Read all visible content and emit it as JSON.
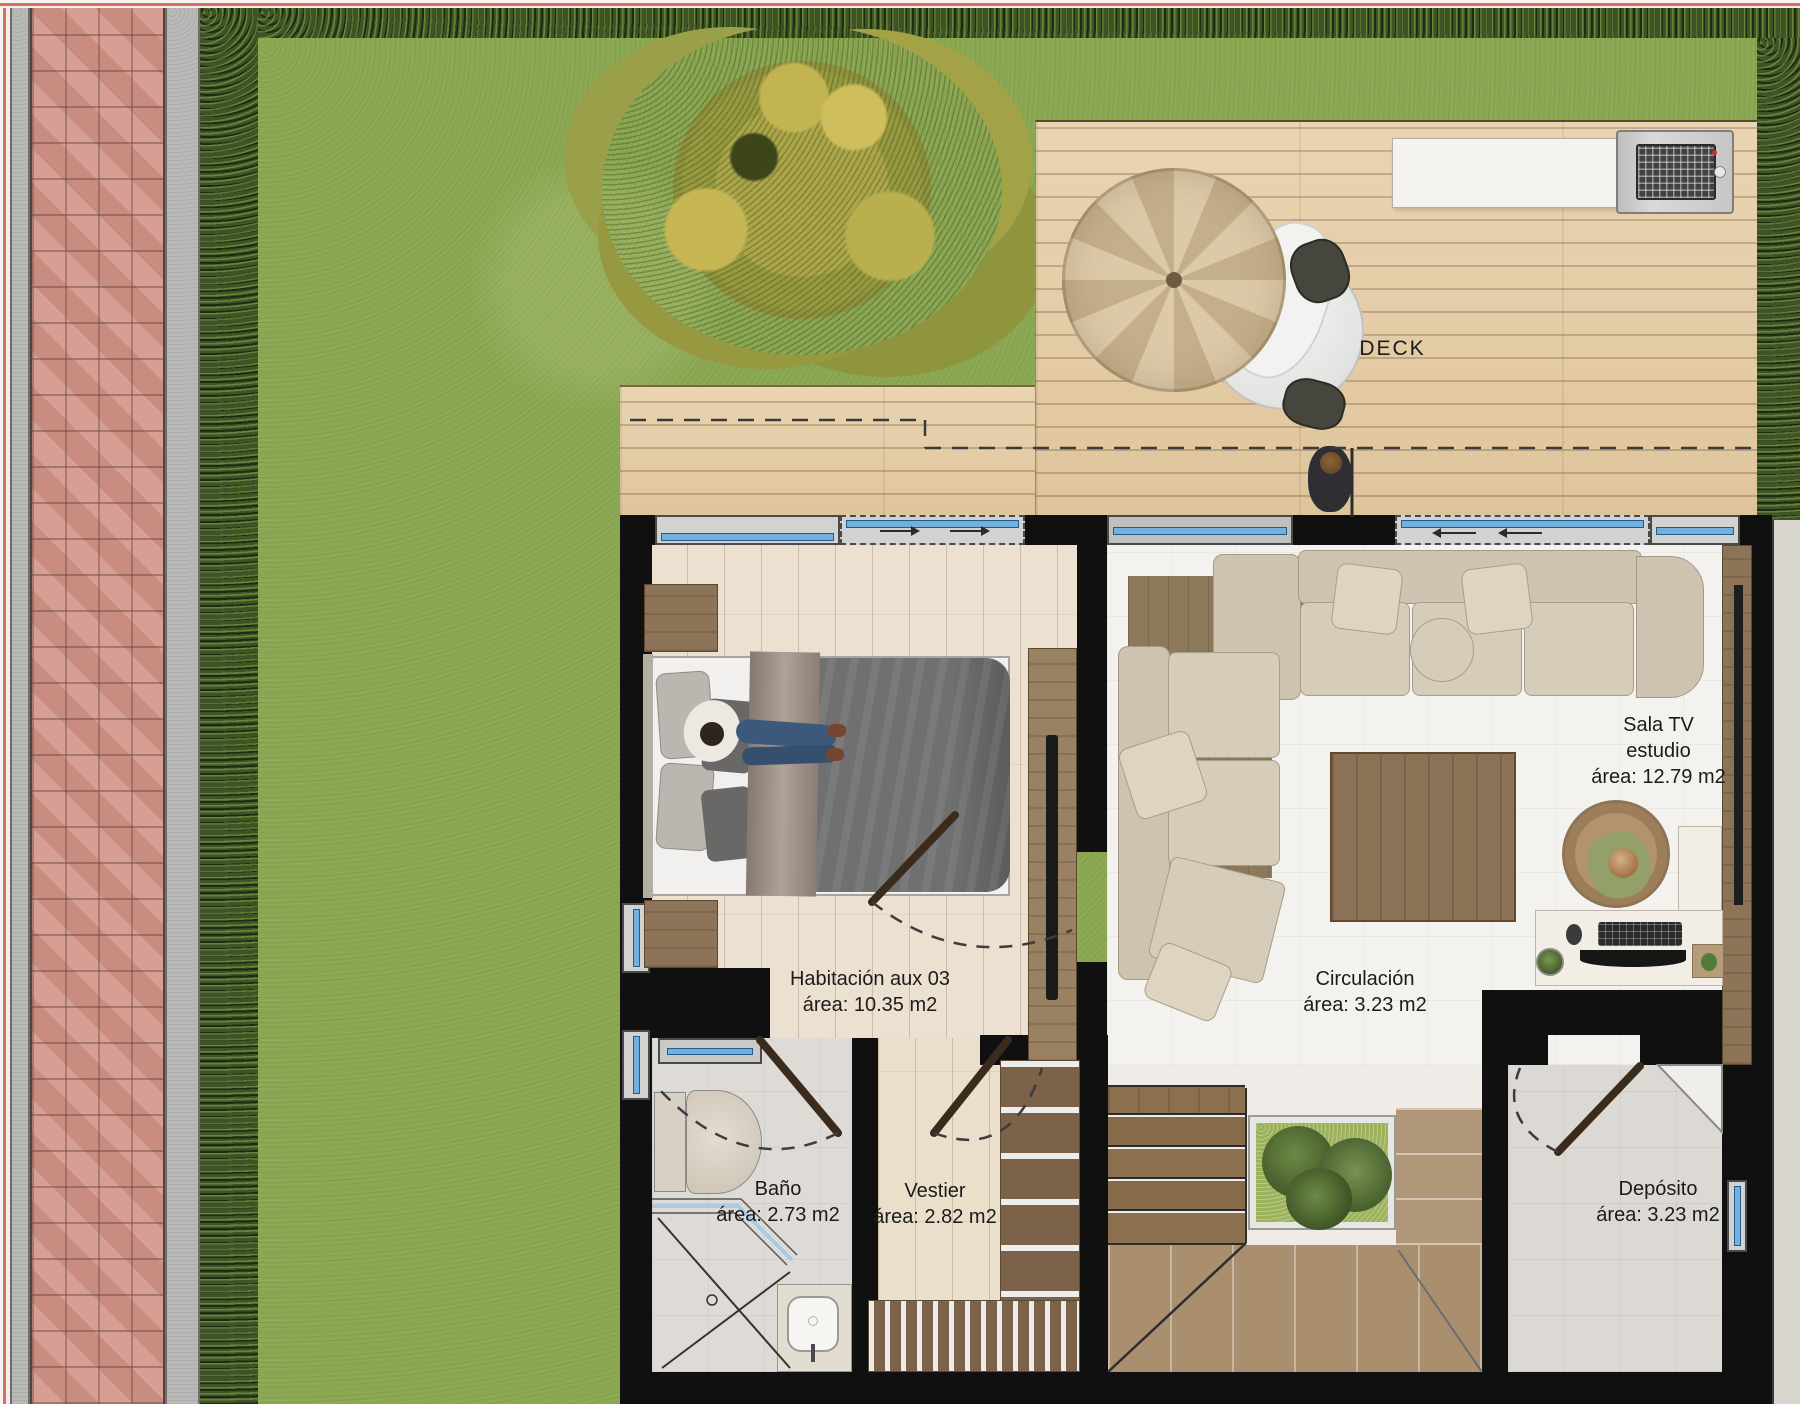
{
  "plan": {
    "deck_label": "DECK",
    "rooms": [
      {
        "name": "Habitación aux 03",
        "area": "área: 10.35 m2"
      },
      {
        "name": "Sala TV",
        "subtitle": "estudio",
        "area": "área: 12.79 m2"
      },
      {
        "name": "Circulación",
        "area": "área: 3.23 m2"
      },
      {
        "name": "Baño",
        "area": "área: 2.73 m2"
      },
      {
        "name": "Vestier",
        "area": "área: 2.82 m2"
      },
      {
        "name": "Depósito",
        "area": "área: 3.23 m2"
      }
    ],
    "colors": {
      "grass": "#8aa751",
      "hedge": "#3f5426",
      "brick_walkway": "#d2958a",
      "deck_wood": "#e7d0a9",
      "wall": "#101010",
      "window_glass": "#74b0dd",
      "furniture_wood": "#8d7458",
      "sofa": "#cdc3b0",
      "duvet": "#707070"
    }
  }
}
